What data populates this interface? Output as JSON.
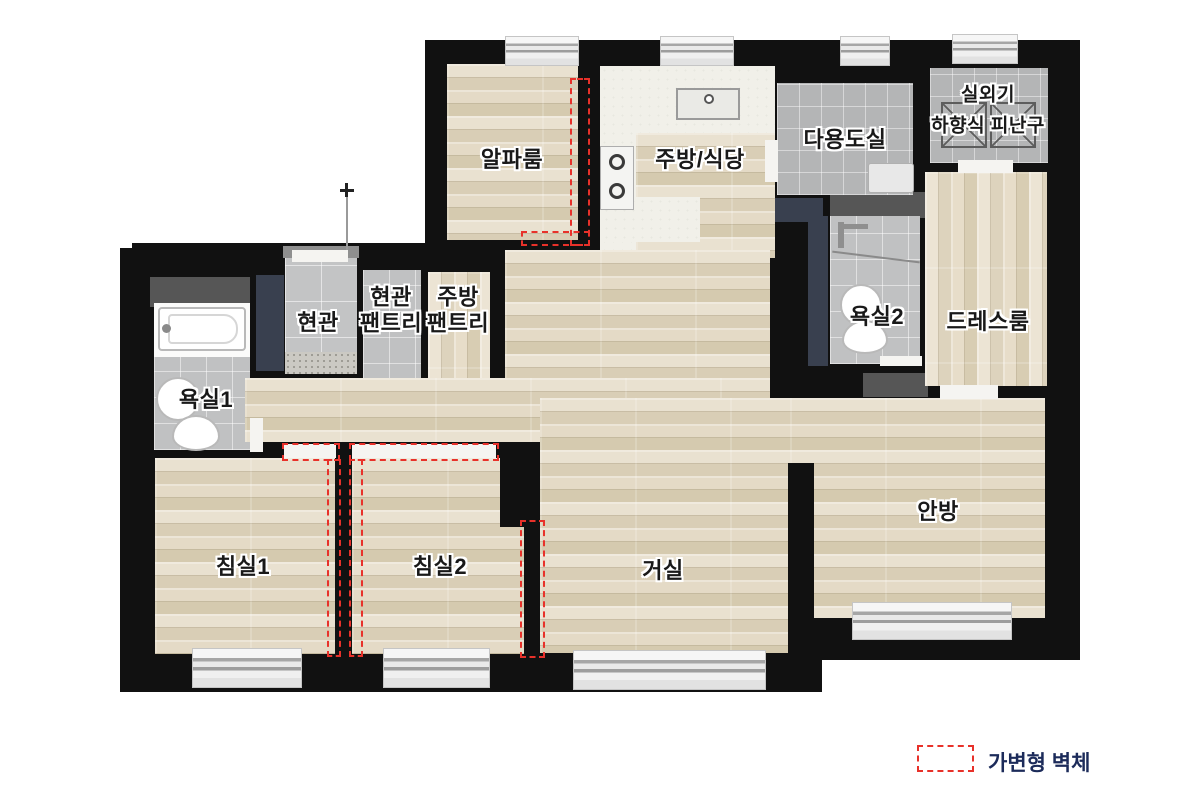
{
  "rooms": {
    "alpha_room": {
      "label": "알파룸"
    },
    "kitchen_dining": {
      "label": "주방/식당"
    },
    "utility_room": {
      "label": "다용도실"
    },
    "outdoor_unit": {
      "label": "실외기"
    },
    "escape_hatch": {
      "label": "하향식 피난구"
    },
    "entrance": {
      "label": "현관"
    },
    "entrance_pantry": {
      "label": "현관\n팬트리"
    },
    "kitchen_pantry": {
      "label": "주방\n팬트리"
    },
    "bathroom1": {
      "label": "욕실1"
    },
    "bathroom2": {
      "label": "욕실2"
    },
    "dress_room": {
      "label": "드레스룸"
    },
    "bedroom1": {
      "label": "침실1"
    },
    "bedroom2": {
      "label": "침실2"
    },
    "living_room": {
      "label": "거실"
    },
    "master_bedroom": {
      "label": "안방"
    }
  },
  "legend": {
    "flexible_wall_label": "가변형 벽체"
  },
  "colors": {
    "wall": "#111111",
    "flexible_wall_dash": "#e8312a",
    "legend_text": "#1c2b5a",
    "wood_floor": "#e0d6c1",
    "tile_floor": "#bfc0c1"
  }
}
